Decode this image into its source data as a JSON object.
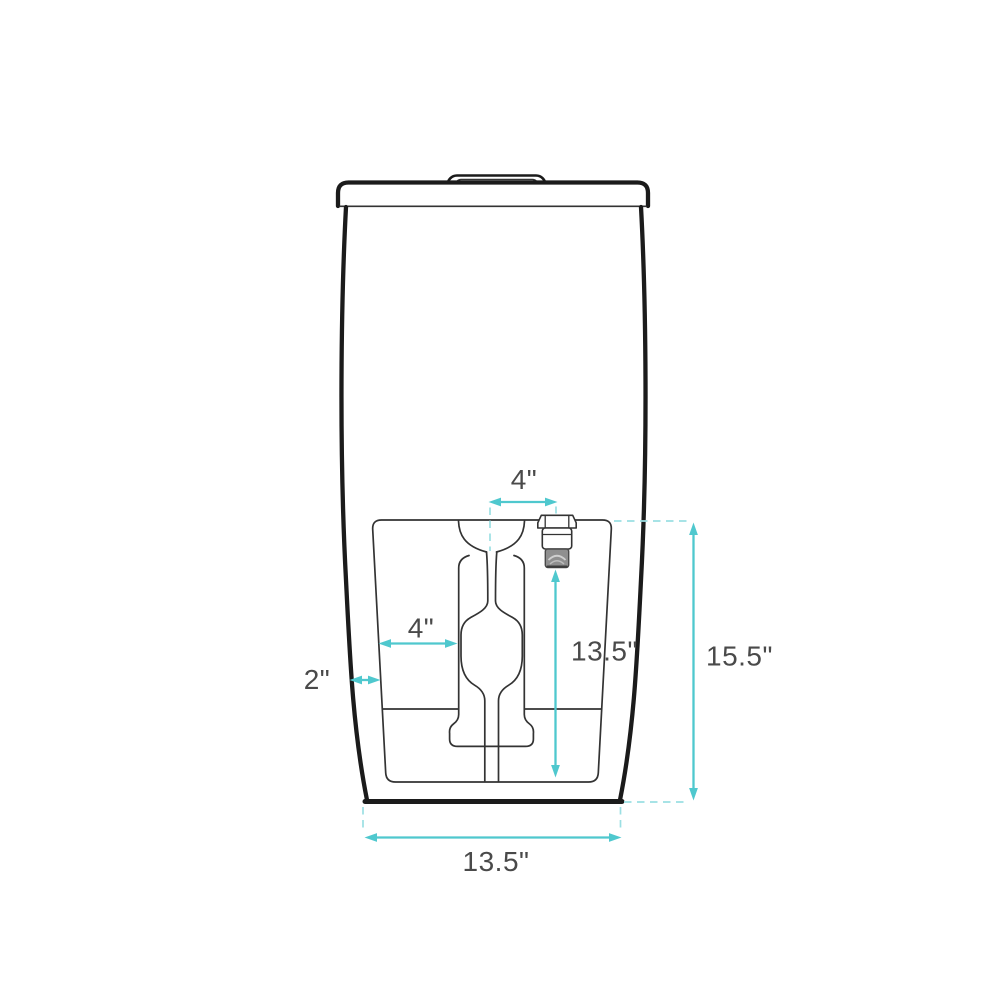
{
  "diagram": {
    "dimensions": [
      {
        "id": "valve-offset-from-center",
        "label": "4\""
      },
      {
        "id": "panel-to-trapway",
        "label": "4\""
      },
      {
        "id": "body-to-panel",
        "label": "2\""
      },
      {
        "id": "valve-height",
        "label": "13.5\""
      },
      {
        "id": "overall-height",
        "label": "15.5\""
      },
      {
        "id": "base-width",
        "label": "13.5\""
      }
    ],
    "colors": {
      "accent": "#4fc8ce",
      "accent_dash": "#9bdfe3",
      "outline": "#1b1b1b",
      "detail_line": "#333333",
      "label_text": "#4a4a4a",
      "valve_shade": "#8f8f8f",
      "background": "#ffffff"
    }
  }
}
